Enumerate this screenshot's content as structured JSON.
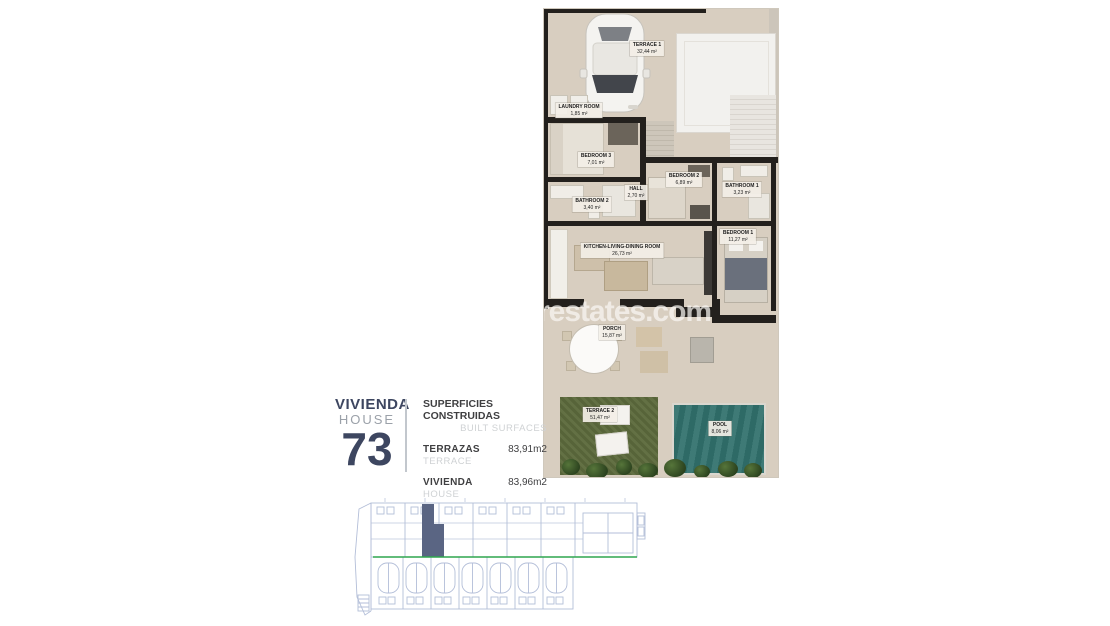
{
  "watermark": "restates.com",
  "colors": {
    "plan_floor": "#d8cec0",
    "plan_wall": "#23201d",
    "grass": "#5e6c3e",
    "pool": "#30706c",
    "navy": "#3d4660",
    "muted_grey": "#9ba1a9",
    "light_grey": "#cfd2d4",
    "siteplan_line": "#b3bed8",
    "siteplan_green": "#2fa64e",
    "siteplan_highlight": "#5a6583"
  },
  "plan": {
    "rooms": [
      {
        "name": "TERRACE 1",
        "area": "32,44 m²"
      },
      {
        "name": "LAUNDRY ROOM",
        "area": "1,85 m²"
      },
      {
        "name": "BEDROOM 3",
        "area": "7,01 m²"
      },
      {
        "name": "BATHROOM 2",
        "area": "3,40 m²"
      },
      {
        "name": "HALL",
        "area": "2,70 m²"
      },
      {
        "name": "BEDROOM 2",
        "area": "6,89 m²"
      },
      {
        "name": "BATHROOM 1",
        "area": "3,23 m²"
      },
      {
        "name": "BEDROOM 1",
        "area": "11,27 m²"
      },
      {
        "name": "KITCHEN-LIVING-DINING ROOM",
        "area": "26,73 m²"
      },
      {
        "name": "PORCH",
        "area": "15,87 m²"
      },
      {
        "name": "TERRACE 2",
        "area": "51,47 m²"
      },
      {
        "name": "POOL",
        "area": "8,06 m²"
      }
    ]
  },
  "info": {
    "unit_label_primary": "VIVIENDA",
    "unit_label_secondary": "HOUSE",
    "unit_number": "73",
    "surfaces_title_primary": "SUPERFICIES CONSTRUIDAS",
    "surfaces_title_secondary": "BUILT SURFACES",
    "rows": [
      {
        "label_primary": "TERRAZAS",
        "label_secondary": "TERRACE",
        "value": "83,91m2"
      },
      {
        "label_primary": "VIVIENDA",
        "label_secondary": "HOUSE",
        "value": "83,96m2"
      }
    ]
  }
}
